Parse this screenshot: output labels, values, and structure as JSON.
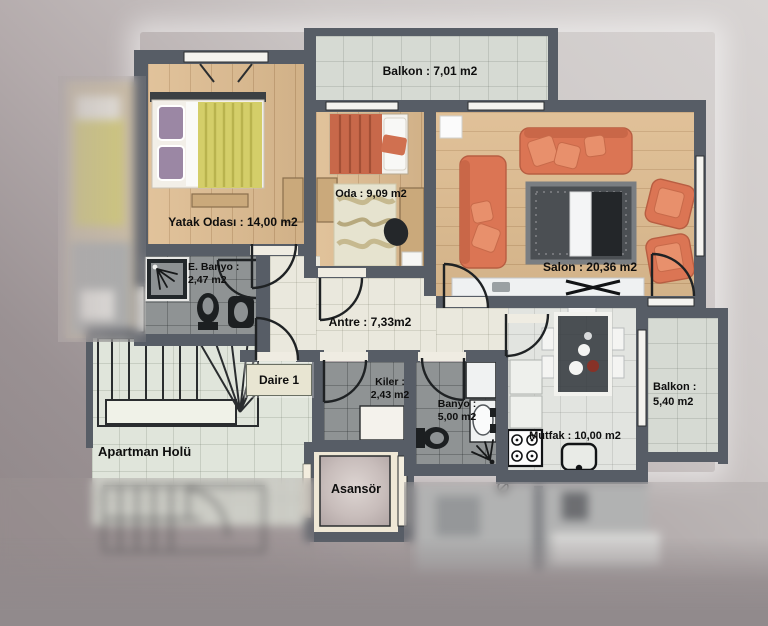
{
  "rooms": {
    "balkon_top": {
      "label": "Balkon : 7,01 m2"
    },
    "yatak_odasi": {
      "label": "Yatak Odası : 14,00 m2"
    },
    "oda": {
      "label": "Oda : 9,09 m2"
    },
    "salon": {
      "label": "Salon : 20,36 m2"
    },
    "e_banyo": {
      "line1": "E. Banyo :",
      "line2": "2,47 m2"
    },
    "antre": {
      "label": "Antre : 7,33m2"
    },
    "daire": {
      "label": "Daire 1"
    },
    "kiler": {
      "line1": "Kiler :",
      "line2": "2,43 m2"
    },
    "banyo": {
      "line1": "Banyo :",
      "line2": "5,00 m2"
    },
    "mutfak": {
      "label": "Mutfak : 10,00 m2"
    },
    "balkon_right": {
      "line1": "Balkon :",
      "line2": "5,40 m2"
    },
    "apartman_holu": {
      "label": "Apartman Holü"
    },
    "asansor": {
      "label": "Asansör"
    }
  },
  "colors": {
    "wall": "#575d66",
    "wood": "#debc90",
    "tile_cream": "#eae8dd",
    "tile_gray": "#8f9394",
    "tile_hall": "#e0e5db",
    "tile_balcony": "#d6dad3",
    "tile_kitchen": "#e2e4e0",
    "sofa_orange": "#db7554",
    "blanket_yellow": "#d4ce69",
    "bed_red": "#c8684a",
    "rug_dark": "#4b4f53",
    "bg_light": "#d8d4d3",
    "bg_dark": "#8d8486"
  }
}
